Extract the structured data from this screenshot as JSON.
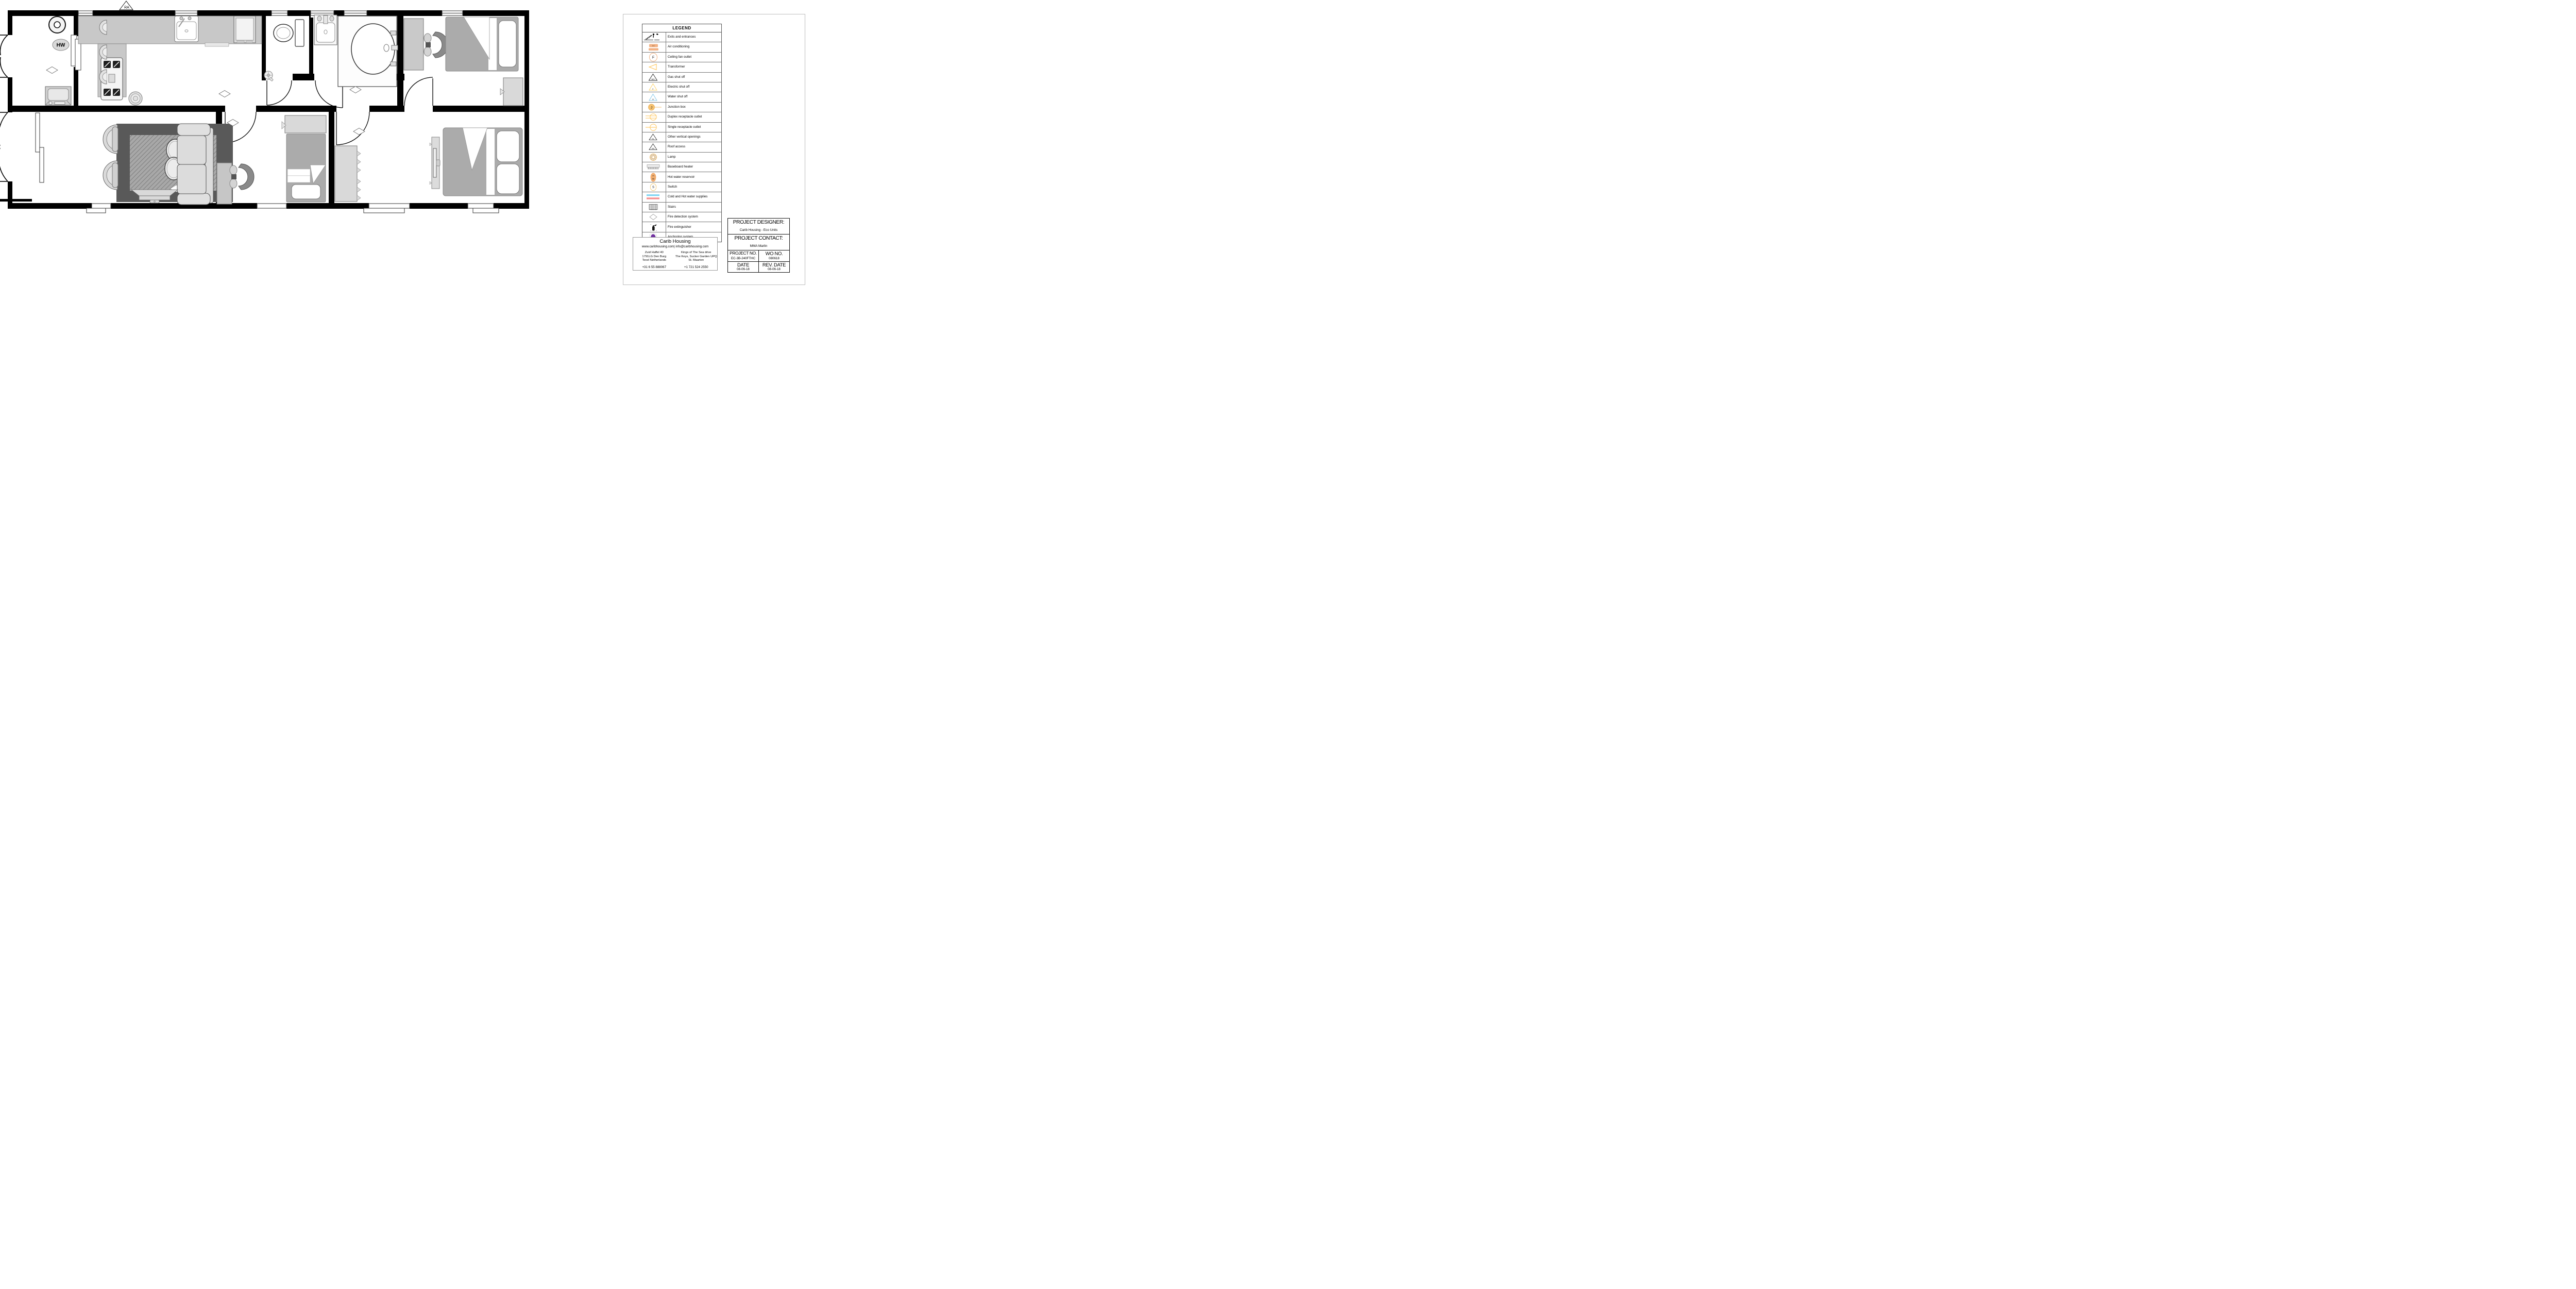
{
  "plan": {
    "labels": {
      "roof_access": "RA",
      "hot_water": "HW"
    }
  },
  "legend": {
    "title": "LEGEND",
    "items": [
      {
        "icon": "exits-entrances",
        "label": "Exits and entrances"
      },
      {
        "icon": "air-conditioning",
        "label": "Air conditioning"
      },
      {
        "icon": "ceiling-fan-outlet",
        "label": "Ceiling fan outlet"
      },
      {
        "icon": "transformer",
        "label": "Transformer"
      },
      {
        "icon": "gas-shut-off",
        "label": "Gas shut off"
      },
      {
        "icon": "electric-shut-off",
        "label": "Electric shut off"
      },
      {
        "icon": "water-shut-off",
        "label": "Water shut off"
      },
      {
        "icon": "junction-box",
        "label": "Junction box"
      },
      {
        "icon": "duplex-receptacle",
        "label": "Duplex receptacle outlet"
      },
      {
        "icon": "single-receptacle",
        "label": "Single receptacle outlet"
      },
      {
        "icon": "other-vertical-openings",
        "label": "Other vertical openings"
      },
      {
        "icon": "roof-access",
        "label": "Roof access"
      },
      {
        "icon": "lamp",
        "label": "Lamp"
      },
      {
        "icon": "baseboard-heater",
        "label": "Baseboard heater"
      },
      {
        "icon": "hot-water-reservoir",
        "label": "Hot water reservoir"
      },
      {
        "icon": "switch",
        "label": "Switch"
      },
      {
        "icon": "cold-hot-water",
        "label": "Cold and Hot water supplies"
      },
      {
        "icon": "stairs",
        "label": "Stairs"
      },
      {
        "icon": "fire-detection",
        "label": "Fire detection system"
      },
      {
        "icon": "fire-extinguisher",
        "label": "Fire extinguisher"
      },
      {
        "icon": "anchoring-system",
        "label": "Anchoring system"
      }
    ],
    "icon_letters": {
      "air-conditioning": "AC",
      "ceiling-fan-outlet": "F",
      "gas-shut-off": "NG",
      "electric-shut-off": "E",
      "water-shut-off": "W",
      "junction-box": "J",
      "other-vertical-openings": "SL",
      "roof-access": "RA",
      "hot-water-reservoir-1": "H",
      "hot-water-reservoir-2": "W",
      "switch": "S"
    }
  },
  "company": {
    "name": "Carib Housing",
    "contact_line": "www.caribhousing.com| info@caribhousing.com",
    "address_left": [
      "Zuid Haffel 40",
      "1791LG Den Burg",
      "Texel Netherlands"
    ],
    "address_right": [
      "Kings of The Sea drive",
      "The Keys, Sucker Garden UPQ",
      "St. Maarten"
    ],
    "phone_left": "+31 6 55 888067",
    "phone_right": "+1 721 524 2550"
  },
  "project": {
    "designer_label": "PROJECT DESIGNER:",
    "designer": "Carib Housing - Eco Units",
    "contact_label": "PROJECT CONTACT:",
    "contact": "MMA Marlin",
    "project_no_label": "PROJECT NO.",
    "project_no": "EC-3B-240FTHC",
    "wo_no_label": "WO NO.",
    "wo_no": "080618",
    "date_label": "DATE",
    "date": "08-06-18",
    "rev_date_label": "REV. DATE",
    "rev_date": "08-06-18"
  },
  "colors": {
    "wall": "#000000",
    "furniture_gray": "#ababab",
    "counter_gray": "#c8c8c8",
    "light_gray": "#d9d9d9",
    "rug_dark": "#595959",
    "ac_orange": "#f2b184",
    "symbol_orange": "#f6c271",
    "symbol_yellow": "#ffc04d",
    "water_blue": "#86c8ea",
    "supply_cyan": "#4cc4ee",
    "supply_red": "#f25050",
    "anchor_purple": "#7030a0"
  }
}
